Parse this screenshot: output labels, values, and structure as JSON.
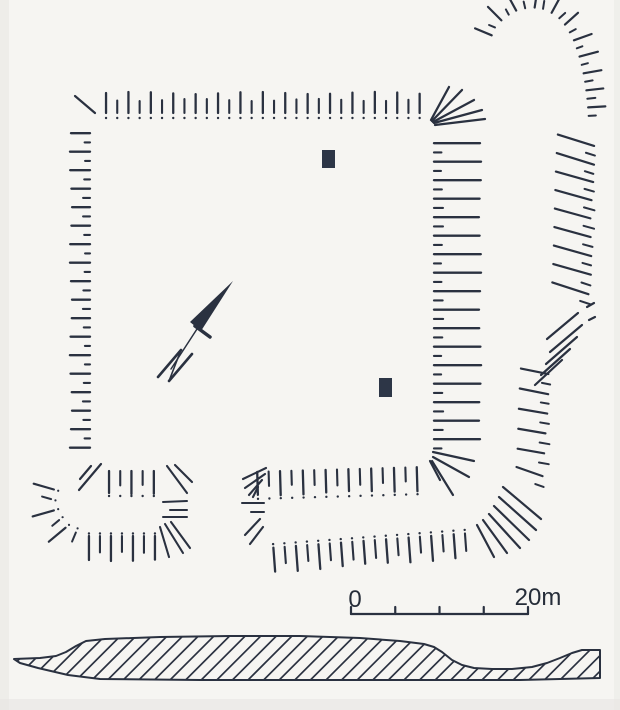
{
  "canvas": {
    "w": 620,
    "h": 710,
    "ink": "#2a3140",
    "paper": "#f6f5f2",
    "building_fill": "#2d3647",
    "edge_shade": "#e7e5e2"
  },
  "scale_bar": {
    "zero_label": "0",
    "end_label": "20m",
    "x1": 351,
    "x2": 528,
    "y": 614,
    "tick_count": 5,
    "tick_h": 7,
    "line_w": 2.2,
    "font_size": 24,
    "zero_pos": {
      "x": 355,
      "y": 607
    },
    "end_pos": {
      "x": 538,
      "y": 605
    }
  },
  "buildings": [
    {
      "x": 322,
      "y": 150,
      "w": 13,
      "h": 18
    },
    {
      "x": 379,
      "y": 378,
      "w": 13,
      "h": 19
    }
  ],
  "north_arrow": {
    "lance": [
      [
        233,
        281
      ],
      [
        190,
        322
      ],
      [
        201,
        331
      ]
    ],
    "crossbar": [
      195,
      326,
      210,
      337,
      3.5
    ],
    "shaft": [
      197,
      329,
      171,
      369,
      1.5
    ],
    "n_strokes": [
      [
        158,
        377,
        181,
        350,
        2.6
      ],
      [
        169,
        381,
        192,
        354,
        2.6
      ],
      [
        181,
        350,
        169,
        381,
        1.6
      ]
    ]
  },
  "hachure_chains": [
    {
      "name": "platform-north-scarp",
      "path": [
        [
          101,
          116
        ],
        [
          424,
          116
        ]
      ],
      "side": 1,
      "spacing": 11.2,
      "long": {
        "o1": 3,
        "o2": 23,
        "w": 2.3
      },
      "short": {
        "o1": 3,
        "o2": 16,
        "w": 2.1
      },
      "dot": -2,
      "dot_r": 1.2,
      "tilt": 0
    },
    {
      "name": "platform-west-scarp",
      "path": [
        [
          91,
          129
        ],
        [
          91,
          451
        ]
      ],
      "side": -1,
      "spacing": 9.25,
      "long": {
        "o1": 1,
        "o2": 20,
        "w": 2.3
      },
      "short": {
        "o1": 1,
        "o2": 7,
        "w": 2.1
      },
      "tilt": 0
    },
    {
      "name": "platform-east-scarp",
      "path": [
        [
          434,
          139
        ],
        [
          434,
          450
        ]
      ],
      "side": 1,
      "spacing": 9.25,
      "long": {
        "o1": 0,
        "o2": 46,
        "w": 2.3
      },
      "short": {
        "o1": 0,
        "o2": 8,
        "w": 2.2
      },
      "tilt": 0
    },
    {
      "name": "platform-south-scarp-east",
      "path": [
        [
          252,
          469
        ],
        [
          424,
          464
        ]
      ],
      "side": -1,
      "spacing": 11.4,
      "long": {
        "o1": 3,
        "o2": 26,
        "w": 2.3
      },
      "short": {
        "o1": 3,
        "o2": 18,
        "w": 2.1
      },
      "dot": 30,
      "dot_r": 1.2,
      "tilt": 0
    },
    {
      "name": "platform-south-scarp-west",
      "path": [
        [
          104,
          468
        ],
        [
          160,
          468
        ]
      ],
      "side": -1,
      "spacing": 11.2,
      "long": {
        "o1": 3,
        "o2": 25,
        "w": 2.3
      },
      "short": {
        "o1": 3,
        "o2": 18,
        "w": 2.1
      },
      "dot": 28,
      "dot_r": 1.2,
      "tilt": 0
    },
    {
      "name": "outer-south-scarp",
      "path": [
        [
          268,
          544
        ],
        [
          470,
          529
        ]
      ],
      "side": -1,
      "spacing": 11.3,
      "long": {
        "o1": 4,
        "o2": 28,
        "w": 2.3
      },
      "short": {
        "o1": 4,
        "o2": 21,
        "w": 2.1
      },
      "dot": 0.5,
      "dot_r": 1.2,
      "tilt": 0
    },
    {
      "name": "annex-outer-south-scarp",
      "path": [
        [
          84,
          533
        ],
        [
          158,
          533
        ]
      ],
      "side": -1,
      "spacing": 11,
      "long": {
        "o1": 3,
        "o2": 27,
        "w": 2.3
      },
      "short": {
        "o1": 3,
        "o2": 20,
        "w": 2.1
      },
      "dot": 0.5,
      "dot_r": 1.2,
      "tilt": 0
    },
    {
      "name": "annex-outer-west-arc",
      "path": [
        [
          58,
          486
        ],
        [
          54,
          500
        ],
        [
          58,
          514
        ],
        [
          68,
          526
        ],
        [
          80,
          531
        ]
      ],
      "side": -1,
      "spacing": 10,
      "long": {
        "o1": 3,
        "o2": 24,
        "w": 2.2
      },
      "short": {
        "o1": 3,
        "o2": 13,
        "w": 2
      },
      "dot": -1.5,
      "dot_r": 1.1,
      "tilt": 0
    },
    {
      "name": "outer-east-scarp-top-arc",
      "path": [
        [
          493,
          40
        ],
        [
          498,
          28
        ],
        [
          507,
          19
        ],
        [
          518,
          13
        ],
        [
          531,
          10
        ],
        [
          544,
          12
        ],
        [
          555,
          18
        ],
        [
          564,
          28
        ],
        [
          571,
          41
        ],
        [
          576,
          55
        ],
        [
          580,
          70
        ],
        [
          583,
          87
        ],
        [
          585,
          105
        ],
        [
          586,
          122
        ]
      ],
      "side": 1,
      "spacing": 8.5,
      "long": {
        "o1": 3,
        "o2": 21,
        "w": 2.2
      },
      "short": {
        "o1": 3,
        "o2": 10,
        "w": 2
      },
      "tilt": 0
    },
    {
      "name": "outer-east-scarp-upper",
      "path": [
        [
          560,
          131
        ],
        [
          558,
          165
        ],
        [
          557,
          200
        ],
        [
          556,
          240
        ],
        [
          555,
          272
        ],
        [
          553,
          300
        ]
      ],
      "side": 1,
      "spacing": 9.25,
      "long": {
        "o1": -2,
        "o2": 36,
        "w": 2.2
      },
      "short": {
        "o1": 28,
        "o2": 38,
        "w": 2
      },
      "tilt": 14
    },
    {
      "name": "outer-east-scarp-lower",
      "path": [
        [
          531,
          366
        ],
        [
          529,
          400
        ],
        [
          528,
          435
        ],
        [
          527,
          465
        ],
        [
          523,
          485
        ]
      ],
      "side": 1,
      "spacing": 10,
      "long": {
        "o1": -10,
        "o2": 18,
        "w": 2.2
      },
      "short": {
        "o1": 12,
        "o2": 21,
        "w": 2
      },
      "tilt": 8
    }
  ],
  "ray_groups": [
    {
      "name": "platform-nw-corner-hachure",
      "w": 2.2,
      "segs": [
        [
          95,
          113,
          75,
          96
        ]
      ]
    },
    {
      "name": "platform-ne-corner-fan",
      "w": 2.3,
      "segs": [
        [
          431,
          120,
          449,
          87
        ],
        [
          432,
          121,
          462,
          90
        ],
        [
          433,
          122,
          474,
          100
        ],
        [
          434,
          123,
          482,
          110
        ],
        [
          435,
          125,
          485,
          119
        ]
      ]
    },
    {
      "name": "platform-se-corner-fan",
      "w": 2.2,
      "segs": [
        [
          433,
          452,
          474,
          461
        ],
        [
          433,
          457,
          469,
          477
        ],
        [
          432,
          461,
          453,
          495
        ],
        [
          430,
          461,
          440,
          480
        ]
      ]
    },
    {
      "name": "platform-sw-corner-hachures",
      "w": 2.2,
      "segs": [
        [
          101,
          464,
          79,
          490
        ],
        [
          91,
          466,
          80,
          479
        ]
      ]
    },
    {
      "name": "annex-east-fan",
      "w": 2.1,
      "segs": [
        [
          167,
          466,
          187,
          493
        ],
        [
          175,
          465,
          192,
          482
        ]
      ]
    },
    {
      "name": "annex-east-scarp",
      "w": 2,
      "segs": [
        [
          163,
          502,
          187,
          501
        ],
        [
          170,
          510,
          187,
          510
        ],
        [
          163,
          517,
          187,
          517
        ]
      ]
    },
    {
      "name": "annex-se-fan",
      "w": 2.1,
      "segs": [
        [
          165,
          524,
          183,
          553
        ],
        [
          171,
          522,
          190,
          548
        ],
        [
          160,
          527,
          169,
          557
        ]
      ]
    },
    {
      "name": "causeway-east-fan-upper",
      "w": 2.1,
      "segs": [
        [
          266,
          468,
          243,
          479
        ],
        [
          265,
          474,
          245,
          488
        ],
        [
          262,
          480,
          249,
          495
        ],
        [
          258,
          487,
          253,
          497
        ]
      ]
    },
    {
      "name": "causeway-east-scarp",
      "w": 2,
      "segs": [
        [
          242,
          503,
          264,
          503
        ],
        [
          251,
          512,
          264,
          512
        ]
      ]
    },
    {
      "name": "causeway-east-fan-lower",
      "w": 2.1,
      "segs": [
        [
          260,
          519,
          245,
          535
        ],
        [
          263,
          527,
          250,
          544
        ]
      ]
    },
    {
      "name": "outer-east-scarp-bend-fan",
      "w": 2.2,
      "segs": [
        [
          578,
          313,
          547,
          339
        ],
        [
          582,
          325,
          550,
          352
        ],
        [
          577,
          337,
          546,
          364
        ],
        [
          570,
          349,
          541,
          375
        ],
        [
          562,
          360,
          535,
          385
        ],
        [
          587,
          307,
          594,
          303
        ],
        [
          589,
          320,
          595,
          317
        ]
      ]
    },
    {
      "name": "outer-south-east-corner-fan",
      "w": 2.2,
      "segs": [
        [
          503,
          487,
          541,
          519
        ],
        [
          499,
          497,
          536,
          530
        ],
        [
          494,
          506,
          529,
          540
        ],
        [
          489,
          514,
          520,
          548
        ],
        [
          483,
          520,
          507,
          553
        ],
        [
          477,
          525,
          494,
          557
        ]
      ]
    }
  ],
  "profile": {
    "outline": [
      [
        14,
        659
      ],
      [
        40,
        658
      ],
      [
        56,
        656
      ],
      [
        66,
        652
      ],
      [
        76,
        646
      ],
      [
        86,
        641
      ],
      [
        105,
        639
      ],
      [
        160,
        637
      ],
      [
        230,
        636
      ],
      [
        300,
        636
      ],
      [
        360,
        638
      ],
      [
        400,
        641
      ],
      [
        424,
        644
      ],
      [
        434,
        647
      ],
      [
        442,
        652
      ],
      [
        452,
        660
      ],
      [
        462,
        665
      ],
      [
        474,
        668
      ],
      [
        492,
        669
      ],
      [
        512,
        669
      ],
      [
        532,
        667
      ],
      [
        547,
        663
      ],
      [
        560,
        658
      ],
      [
        572,
        653
      ],
      [
        582,
        650
      ],
      [
        600,
        650
      ],
      [
        600,
        678
      ],
      [
        520,
        680
      ],
      [
        380,
        680
      ],
      [
        200,
        680
      ],
      [
        100,
        679
      ],
      [
        68,
        675
      ],
      [
        38,
        668
      ],
      [
        20,
        663
      ]
    ],
    "outline_w": 2,
    "hatch": {
      "step": 15.6,
      "len": 80,
      "w": 1.7,
      "x_from": -80,
      "x_to": 620,
      "y_bottom": 696,
      "y_top": 616
    }
  }
}
